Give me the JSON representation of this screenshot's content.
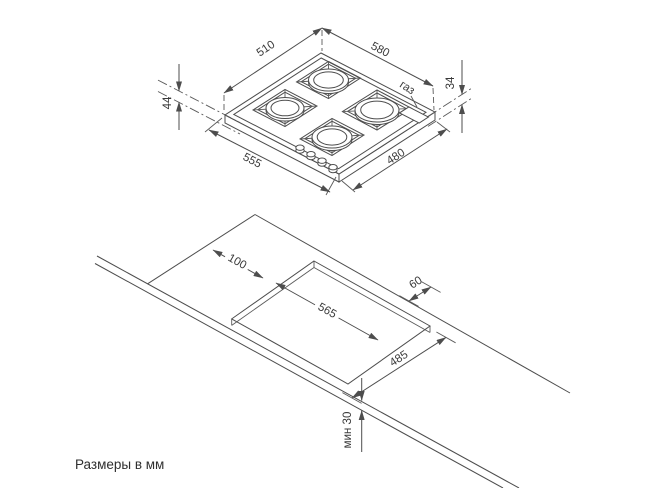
{
  "caption": "Размеры в мм",
  "colors": {
    "line": "#4d4d4d",
    "text": "#3a3a3a",
    "background": "#ffffff"
  },
  "top_view": {
    "title": "hob isometric view",
    "dims": {
      "top_width": "510",
      "top_depth": "580",
      "height_total": "44",
      "height_body": "34",
      "gas": "газ",
      "bottom_width": "555",
      "bottom_depth": "480"
    }
  },
  "cutout_view": {
    "title": "worktop cutout view",
    "dims": {
      "side_clearance": "100",
      "cutout_width": "565",
      "back_clearance": "60",
      "cutout_depth": "485",
      "front_min": "мин 30"
    }
  }
}
